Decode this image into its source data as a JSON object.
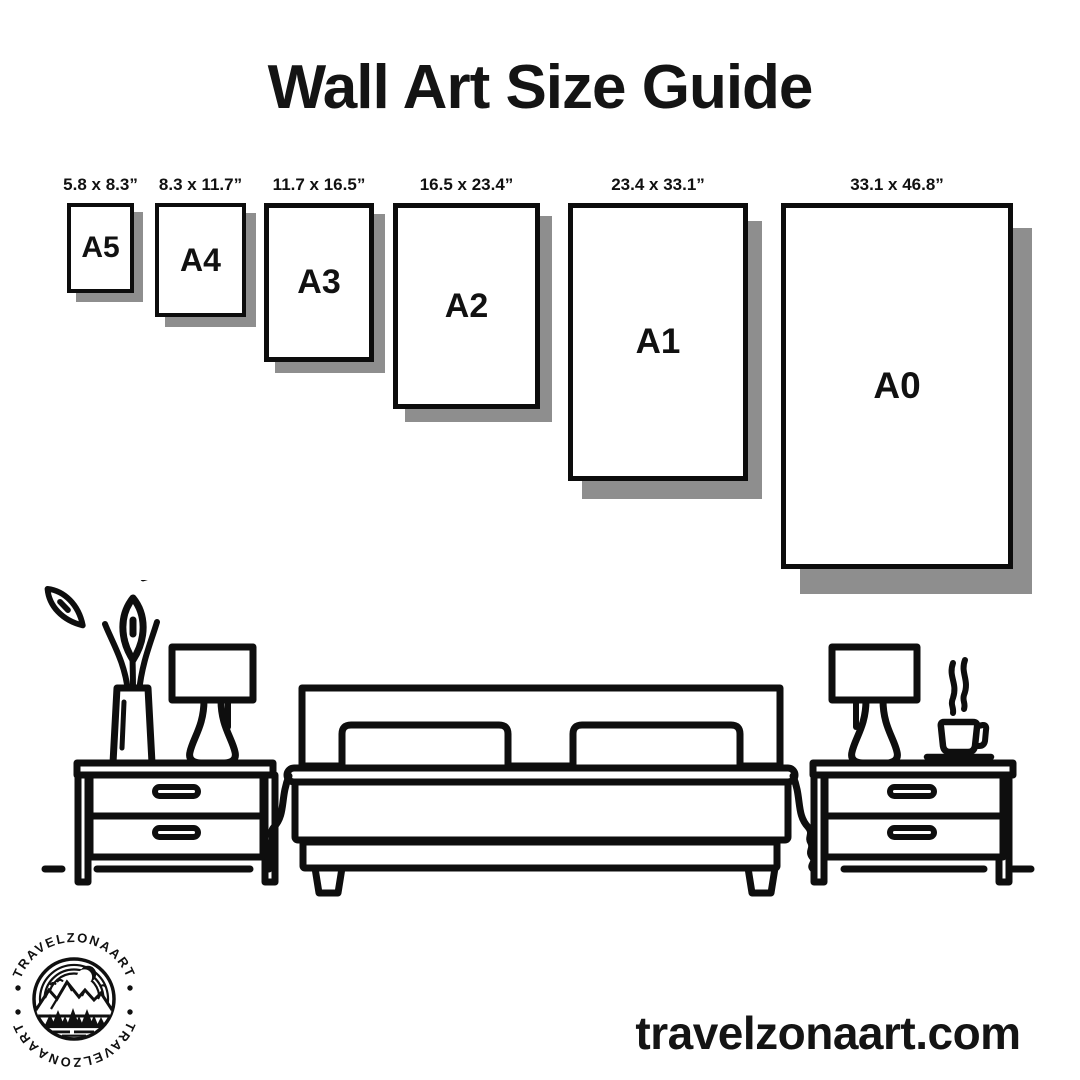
{
  "title": "Wall Art Size Guide",
  "website": "travelzonaart.com",
  "logo": {
    "brand_top": "TRAVELZONAART",
    "brand_bottom": "TRAVELZONAART"
  },
  "colors": {
    "ink": "#0e0e0e",
    "frame_border": "#0c0c0c",
    "frame_shadow": "#8e8e8e",
    "background": "#ffffff"
  },
  "sizes": [
    {
      "label": "A5",
      "dimensions": "5.8 x 8.3”"
    },
    {
      "label": "A4",
      "dimensions": "8.3 x 11.7”"
    },
    {
      "label": "A3",
      "dimensions": "11.7 x 16.5”"
    },
    {
      "label": "A2",
      "dimensions": "16.5 x 23.4”"
    },
    {
      "label": "A1",
      "dimensions": "23.4 x 33.1”"
    },
    {
      "label": "A0",
      "dimensions": "33.1 x 46.8”"
    }
  ],
  "scene_items": [
    "flower-vase",
    "table-lamp",
    "nightstand",
    "double-bed",
    "nightstand",
    "table-lamp",
    "coffee-cup"
  ]
}
